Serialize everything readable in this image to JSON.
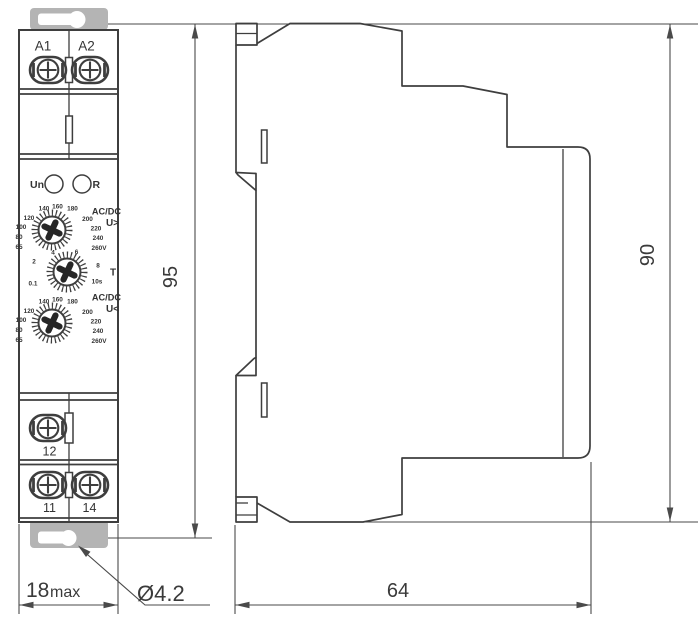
{
  "drawing": {
    "front_view": {
      "terminal_labels_top": [
        "A1",
        "A2"
      ],
      "led_left_label": "Un",
      "led_right_label": "R",
      "dial_overvoltage": {
        "type_label": "AC/DC",
        "threshold_label": "U>",
        "scale": [
          "65",
          "80",
          "100",
          "120",
          "140",
          "160",
          "180",
          "200",
          "220",
          "240",
          "260V"
        ]
      },
      "dial_time": {
        "label": "T",
        "scale": [
          "0.1",
          "2",
          "4",
          "6",
          "8",
          "10s"
        ]
      },
      "dial_undervoltage": {
        "type_label": "AC/DC",
        "threshold_label": "U<",
        "scale": [
          "65",
          "80",
          "100",
          "120",
          "140",
          "160",
          "180",
          "200",
          "220",
          "240",
          "260V"
        ]
      },
      "terminal_labels_bottom": [
        "12",
        "11",
        "14"
      ]
    },
    "dimensions": {
      "front_height": "95",
      "side_height": "90",
      "front_width_value": "18",
      "front_width_suffix": "max",
      "side_depth": "64",
      "hole_diameter": "Ø4.2"
    },
    "colors": {
      "line": "#3e3e3e",
      "dim": "#4a4a4a",
      "clip_gray": "#b4b4b4"
    }
  }
}
